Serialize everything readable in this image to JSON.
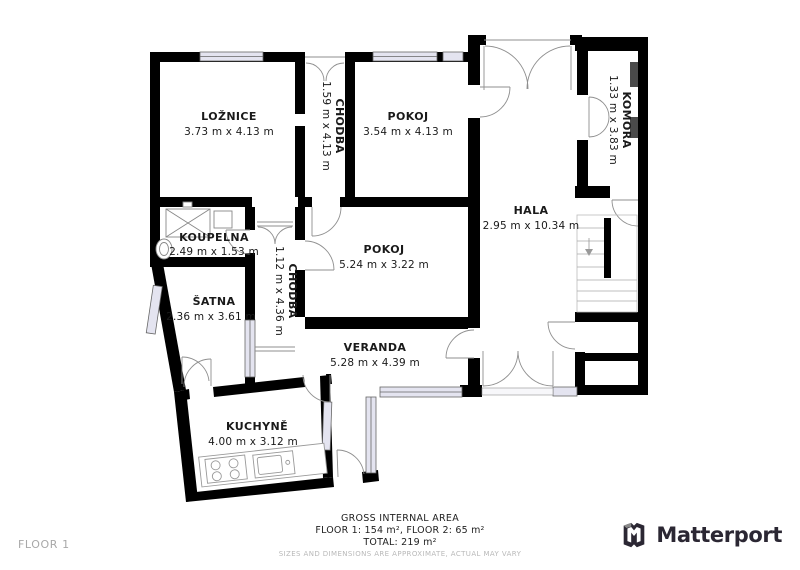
{
  "floor_label": "FLOOR 1",
  "footer": {
    "gross_internal_area": "GROSS INTERNAL AREA",
    "floors_line": "FLOOR 1: 154 m², FLOOR 2: 65 m²",
    "total_line": "TOTAL: 219 m²",
    "disclaimer": "SIZES AND DIMENSIONS ARE APPROXIMATE, ACTUAL MAY VARY"
  },
  "brand": {
    "name": "Matterport",
    "icon": "matterport-m-cube-icon"
  },
  "rooms": [
    {
      "name": "LOŽNICE",
      "dimensions": "3.73 m x 4.13 m",
      "orientation": "horizontal"
    },
    {
      "name": "CHODBA",
      "dimensions": "1.59 m x 4.13 m",
      "orientation": "vertical"
    },
    {
      "name": "POKOJ",
      "dimensions": "3.54 m x 4.13 m",
      "orientation": "horizontal"
    },
    {
      "name": "KOMORA",
      "dimensions": "1.33 m x 3.83 m",
      "orientation": "vertical"
    },
    {
      "name": "HALA",
      "dimensions": "2.95 m x 10.34 m",
      "orientation": "horizontal"
    },
    {
      "name": "KOUPELNA",
      "dimensions": "2.49 m x 1.53 m",
      "orientation": "horizontal"
    },
    {
      "name": "CHODBA",
      "dimensions": "1.12 m x 4.36 m",
      "orientation": "vertical"
    },
    {
      "name": "POKOJ",
      "dimensions": "5.24 m x 3.22 m",
      "orientation": "horizontal"
    },
    {
      "name": "ŠATNA",
      "dimensions": "2.36 m x 3.61 m",
      "orientation": "horizontal"
    },
    {
      "name": "VERANDA",
      "dimensions": "5.28 m x 4.39 m",
      "orientation": "horizontal"
    },
    {
      "name": "KUCHYNĚ",
      "dimensions": "4.00 m x 3.12 m",
      "orientation": "horizontal"
    }
  ],
  "colors": {
    "wall": "#000000",
    "window_fill": "#e4e4f0",
    "door_stroke": "#8f8f8f",
    "muted_text": "#a8a8a8",
    "brand_dark": "#2b2733"
  }
}
